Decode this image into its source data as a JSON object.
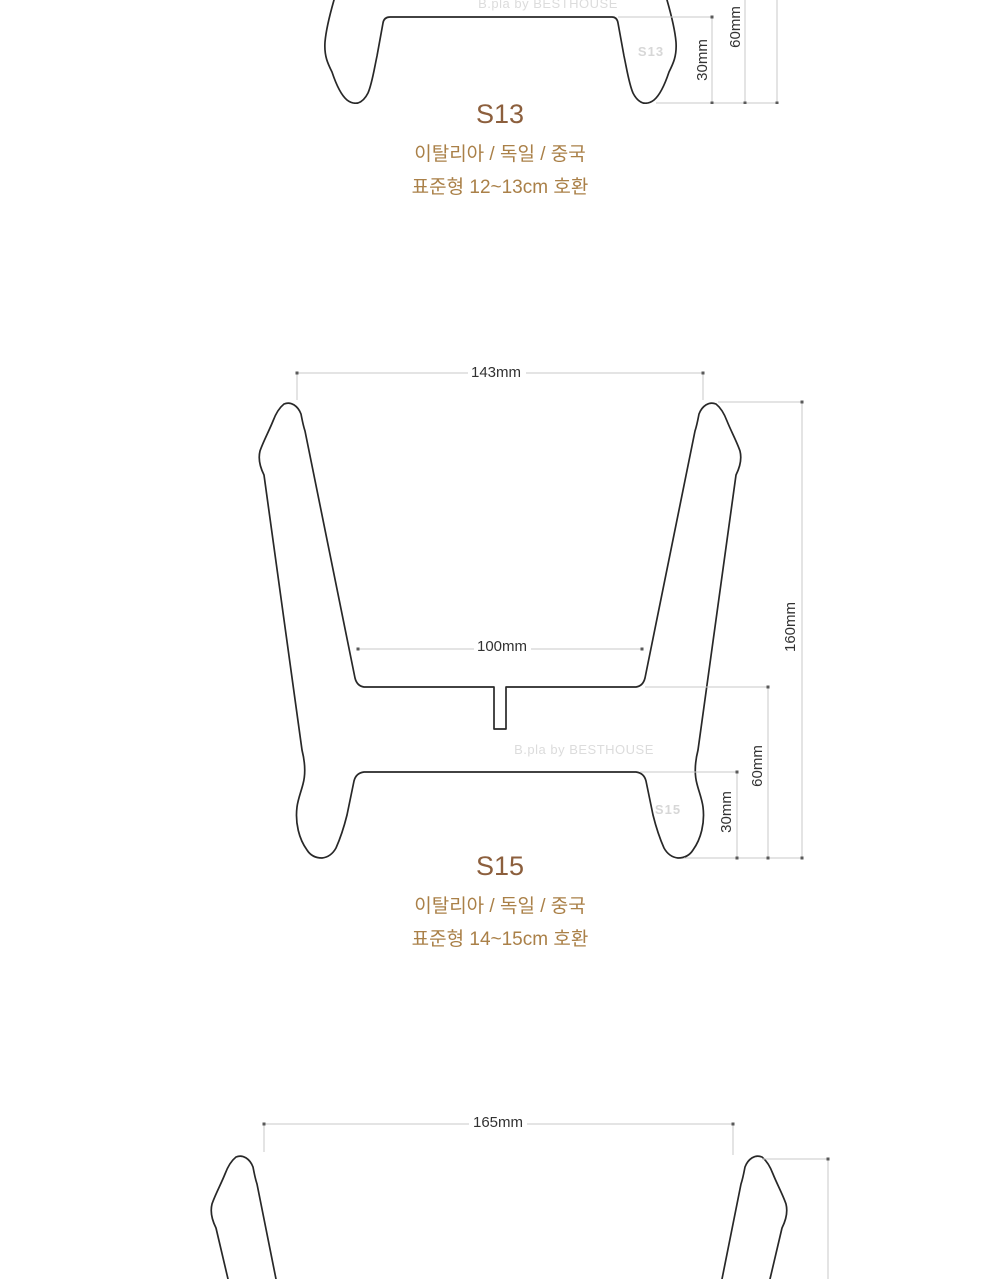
{
  "colors": {
    "background": "#ffffff",
    "outline": "#282828",
    "dimension_line": "#c9c9c9",
    "dimension_text": "#323232",
    "title_text": "#8c5f3d",
    "description_text": "#aa8048",
    "watermark_text": "#dcdcdc"
  },
  "brand_watermark": "B.pla by BESTHOUSE",
  "sections": [
    {
      "model": "S13",
      "origin": "이탈리아 / 독일 / 중국",
      "compat": "표준형 12~13cm 호환",
      "watermark_model": "S13",
      "dims": {
        "d30": "30mm",
        "d60": "60mm"
      }
    },
    {
      "model": "S15",
      "origin": "이탈리아 / 독일 / 중국",
      "compat": "표준형 14~15cm 호환",
      "watermark_model": "S15",
      "dims": {
        "w_top": "143mm",
        "w_inner": "100mm",
        "h_total": "160mm",
        "d60": "60mm",
        "d30": "30mm"
      }
    },
    {
      "dims": {
        "w_top": "165mm"
      }
    }
  ]
}
